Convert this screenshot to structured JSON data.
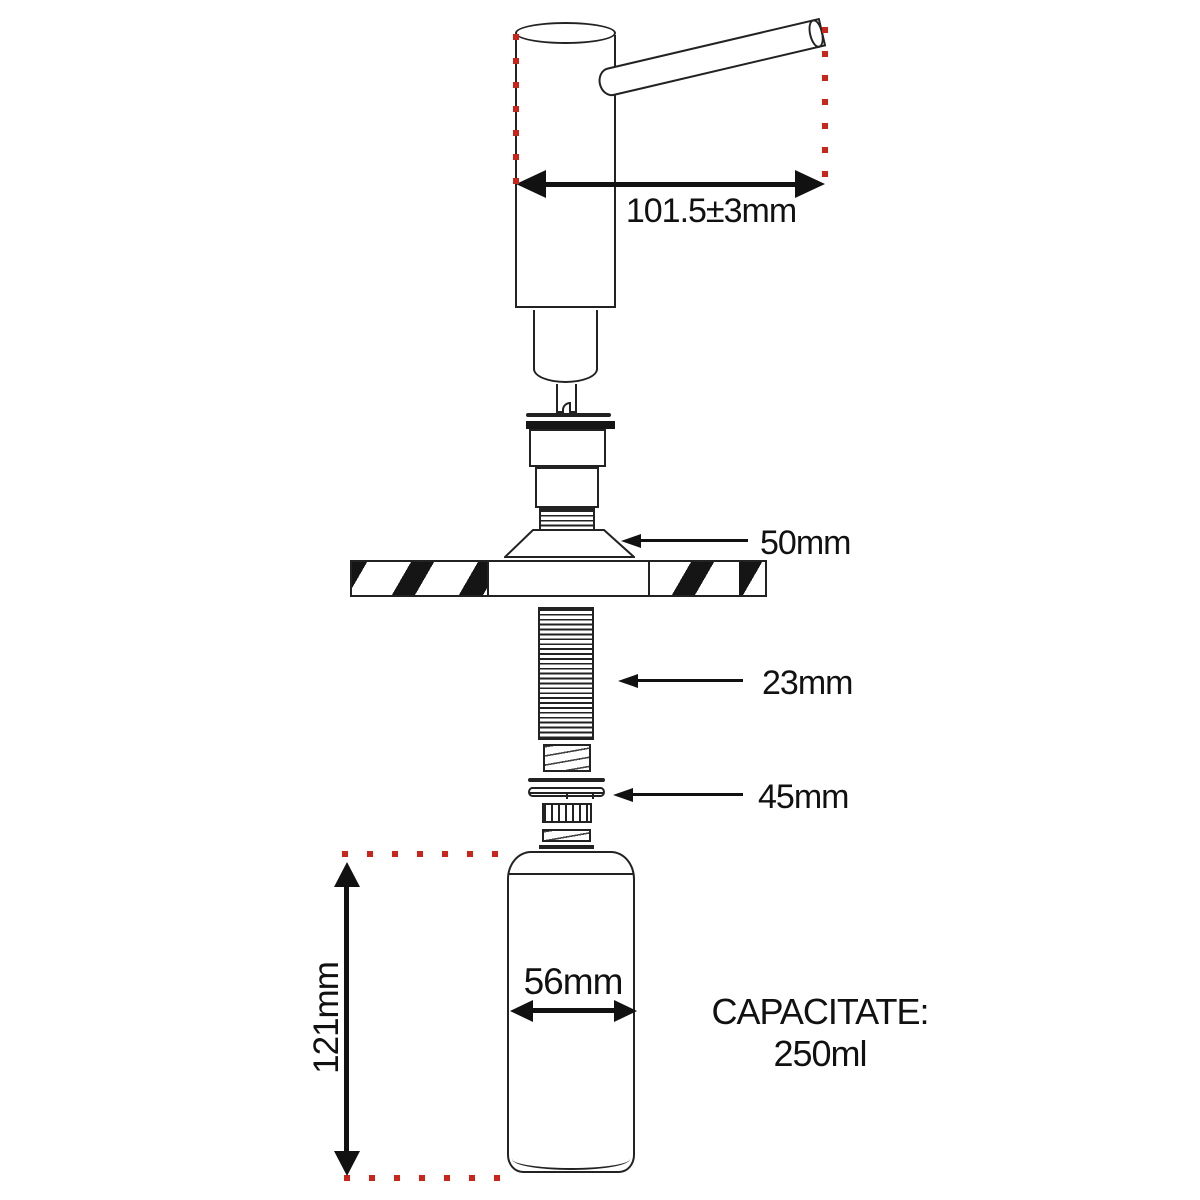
{
  "diagram": {
    "title_hint": "soap dispenser installation dimensions",
    "dimensions": {
      "spout_reach": "101.5±3mm",
      "flange_diameter": "50mm",
      "thread_length": "23mm",
      "locknut_diameter": "45mm",
      "bottle_diameter": "56mm",
      "bottle_height": "121mm"
    },
    "capacity": {
      "label": "CAPACITATE:",
      "value": "250ml"
    },
    "colors": {
      "outline": "#222222",
      "arrow_and_text": "#111111",
      "guide_red": "#cb241b",
      "background": "#ffffff"
    }
  }
}
